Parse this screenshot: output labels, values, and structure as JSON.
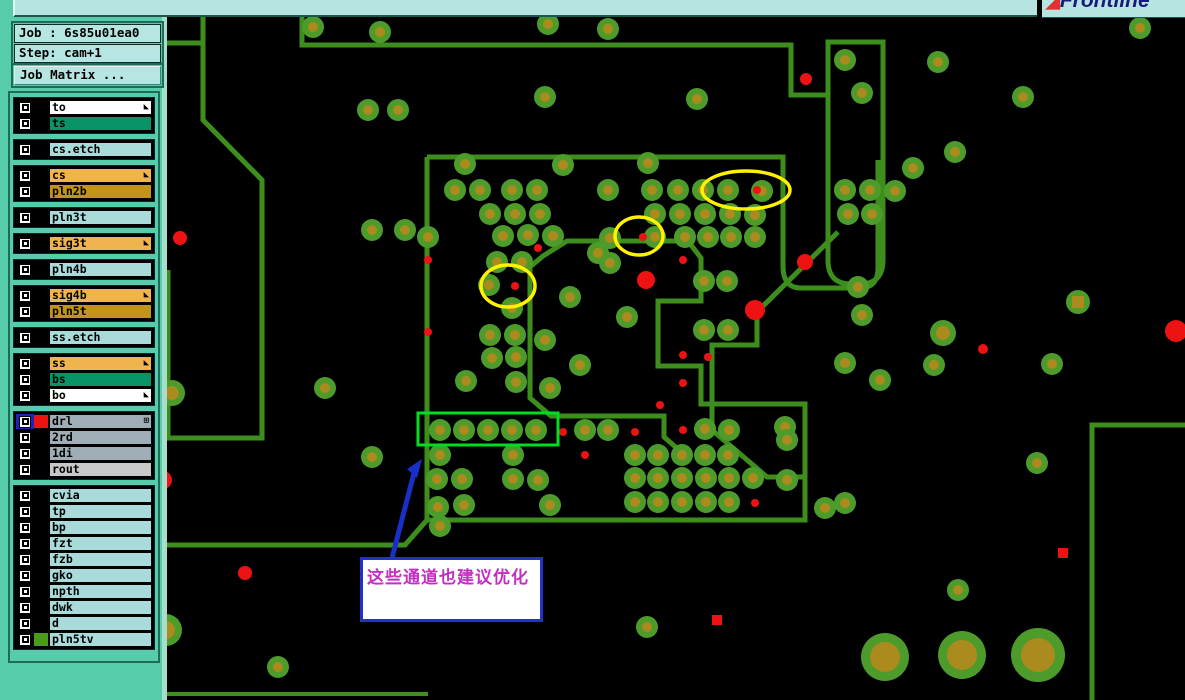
{
  "window": {
    "logo_text": "Frontline",
    "logo_swoosh_icon": "◢"
  },
  "job_panel": {
    "job_label": "Job : 6s85u01ea0",
    "step_label": "Step: cam+1",
    "matrix_button": "Job Matrix ..."
  },
  "colors": {
    "sidebar_teal": "#56CCAA",
    "panel_light": "#B6E6E2",
    "row_blue": "#A9DBDB",
    "row_orange": "#F0B44E",
    "row_gold": "#C2941C",
    "row_green": "#089367",
    "row_gray": "#9FAEB6",
    "row_rout": "#C8C8C8",
    "selected_checkbox_blue": "#2222BB",
    "drl_swatch_red": "#EE1313",
    "pln5tv_swatch_green": "#4A9A20"
  },
  "layers": [
    {
      "name": "to",
      "bg": "#FFFFFF",
      "group": 0,
      "arrow": true
    },
    {
      "name": "ts",
      "bg": "#089367",
      "group": 0
    },
    {
      "name": "cs.etch",
      "bg": "#A9DBDB",
      "group": 1
    },
    {
      "name": "cs",
      "bg": "#F0B44E",
      "group": 2,
      "arrow": true
    },
    {
      "name": "pln2b",
      "bg": "#C2941C",
      "group": 2
    },
    {
      "name": "pln3t",
      "bg": "#A9DBDB",
      "group": 3
    },
    {
      "name": "sig3t",
      "bg": "#F0B44E",
      "group": 4,
      "arrow": true
    },
    {
      "name": "pln4b",
      "bg": "#A9DBDB",
      "group": 5
    },
    {
      "name": "sig4b",
      "bg": "#F0B44E",
      "group": 6,
      "arrow": true
    },
    {
      "name": "pln5t",
      "bg": "#C2941C",
      "group": 6
    },
    {
      "name": "ss.etch",
      "bg": "#A9DBDB",
      "group": 7
    },
    {
      "name": "ss",
      "bg": "#F0B44E",
      "group": 8,
      "arrow": true
    },
    {
      "name": "bs",
      "bg": "#089367",
      "group": 8
    },
    {
      "name": "bo",
      "bg": "#FFFFFF",
      "group": 8,
      "arrow": true
    },
    {
      "name": "drl",
      "bg": "#9FAEB6",
      "group": 9,
      "selected": true,
      "swatch": "#EE1313",
      "grid": true
    },
    {
      "name": "2rd",
      "bg": "#9FAEB6",
      "group": 9
    },
    {
      "name": "1di",
      "bg": "#9FAEB6",
      "group": 9
    },
    {
      "name": "rout",
      "bg": "#C8C8C8",
      "group": 9
    },
    {
      "name": "cvia",
      "bg": "#A9DBDB",
      "group": 10
    },
    {
      "name": "tp",
      "bg": "#A9DBDB",
      "group": 10
    },
    {
      "name": "bp",
      "bg": "#A9DBDB",
      "group": 10
    },
    {
      "name": "fzt",
      "bg": "#A9DBDB",
      "group": 10
    },
    {
      "name": "fzb",
      "bg": "#A9DBDB",
      "group": 10
    },
    {
      "name": "gko",
      "bg": "#A9DBDB",
      "group": 10
    },
    {
      "name": "npth",
      "bg": "#A9DBDB",
      "group": 10
    },
    {
      "name": "dwk",
      "bg": "#A9DBDB",
      "group": 10
    },
    {
      "name": "d",
      "bg": "#A9DBDB",
      "group": 10
    },
    {
      "name": "pln5tv",
      "bg": "#A9DBDB",
      "group": 10,
      "swatch": "#4A9A20"
    }
  ],
  "canvas": {
    "background": "#000000",
    "trace_color": "#3E8E1E",
    "pad_outer": "#4C9B2B",
    "pad_inner": "#AB8A1E",
    "drill_color": "#EE1313",
    "highlight_yellow": "#FFF200",
    "highlight_green": "#00DD22",
    "arrow_color": "#1830C8",
    "traces": [
      {
        "d": "M203,17 L203,120 L262,180 L262,438 L168,438 L168,270",
        "w": 5
      },
      {
        "d": "M167,43 L203,43",
        "w": 5
      },
      {
        "d": "M302,17 L302,45 L791,45 L791,95 L828,95",
        "w": 5
      },
      {
        "d": "M828,95 L828,42 L883,42 L883,260 Q883,284 860,284 L851,284 Q828,284 828,260 L828,95",
        "w": 5
      },
      {
        "d": "M427,157 L783,157 L783,266 Q783,288 801,288 L860,288 Q878,288 878,268 L878,160",
        "w": 5
      },
      {
        "d": "M427,157 L427,520 L805,520 L805,404 L701,404 L701,366 L658,366 L658,301 L701,301 L701,258 L688,241 L567,241 L543,256 L530,267 L530,398 L551,416 L664,416 L664,437 L686,456",
        "w": 5
      },
      {
        "d": "M427,520 L405,545 L167,545",
        "w": 5
      },
      {
        "d": "M838,232 L757,312 L757,345 L712,345 L712,430 L767,477 L805,477",
        "w": 5
      },
      {
        "d": "M1092,700 L1092,425 L1185,425",
        "w": 5
      },
      {
        "d": "M167,694 L428,694",
        "w": 4
      }
    ],
    "pads": [
      [
        313,
        27,
        "s"
      ],
      [
        380,
        32,
        "s"
      ],
      [
        548,
        24,
        "s"
      ],
      [
        608,
        29,
        "s"
      ],
      [
        545,
        97,
        "s"
      ],
      [
        697,
        99,
        "s"
      ],
      [
        368,
        110,
        "s"
      ],
      [
        398,
        110,
        "s"
      ],
      [
        372,
        230,
        "s"
      ],
      [
        405,
        230,
        "s"
      ],
      [
        845,
        60,
        "s"
      ],
      [
        862,
        93,
        "s"
      ],
      [
        938,
        62,
        "s"
      ],
      [
        1023,
        97,
        "s"
      ],
      [
        1140,
        28,
        "s"
      ],
      [
        913,
        168,
        "s"
      ],
      [
        955,
        152,
        "s"
      ],
      [
        465,
        164,
        "s"
      ],
      [
        563,
        165,
        "s"
      ],
      [
        648,
        163,
        "s"
      ],
      [
        455,
        190,
        "s"
      ],
      [
        480,
        190,
        "s"
      ],
      [
        512,
        190,
        "s"
      ],
      [
        537,
        190,
        "s"
      ],
      [
        608,
        190,
        "s"
      ],
      [
        652,
        190,
        "s"
      ],
      [
        678,
        190,
        "s"
      ],
      [
        703,
        190,
        "s"
      ],
      [
        728,
        190,
        "s"
      ],
      [
        762,
        191,
        "s"
      ],
      [
        845,
        190,
        "s"
      ],
      [
        870,
        190,
        "s"
      ],
      [
        895,
        191,
        "s"
      ],
      [
        848,
        214,
        "s"
      ],
      [
        872,
        214,
        "s"
      ],
      [
        490,
        214,
        "s"
      ],
      [
        515,
        214,
        "s"
      ],
      [
        540,
        214,
        "s"
      ],
      [
        655,
        214,
        "s"
      ],
      [
        680,
        214,
        "s"
      ],
      [
        705,
        214,
        "s"
      ],
      [
        730,
        214,
        "s"
      ],
      [
        755,
        215,
        "s"
      ],
      [
        428,
        237,
        "s"
      ],
      [
        503,
        236,
        "s"
      ],
      [
        528,
        235,
        "s"
      ],
      [
        553,
        236,
        "s"
      ],
      [
        610,
        238,
        "s"
      ],
      [
        655,
        237,
        "s"
      ],
      [
        685,
        237,
        "s"
      ],
      [
        708,
        237,
        "s"
      ],
      [
        731,
        237,
        "s"
      ],
      [
        755,
        237,
        "s"
      ],
      [
        497,
        262,
        "s"
      ],
      [
        522,
        262,
        "s"
      ],
      [
        610,
        263,
        "s"
      ],
      [
        489,
        285,
        "s"
      ],
      [
        512,
        308,
        "s"
      ],
      [
        490,
        335,
        "s"
      ],
      [
        515,
        335,
        "s"
      ],
      [
        492,
        358,
        "s"
      ],
      [
        516,
        357,
        "s"
      ],
      [
        466,
        381,
        "s"
      ],
      [
        516,
        382,
        "s"
      ],
      [
        598,
        253,
        "s"
      ],
      [
        570,
        297,
        "s"
      ],
      [
        627,
        317,
        "s"
      ],
      [
        545,
        340,
        "s"
      ],
      [
        580,
        365,
        "s"
      ],
      [
        550,
        388,
        "s"
      ],
      [
        704,
        281,
        "s"
      ],
      [
        727,
        281,
        "s"
      ],
      [
        704,
        330,
        "s"
      ],
      [
        728,
        330,
        "s"
      ],
      [
        858,
        287,
        "s"
      ],
      [
        862,
        315,
        "s"
      ],
      [
        845,
        363,
        "s"
      ],
      [
        880,
        380,
        "s"
      ],
      [
        934,
        365,
        "s"
      ],
      [
        1052,
        364,
        "s"
      ],
      [
        958,
        590,
        "s"
      ],
      [
        1037,
        463,
        "s"
      ],
      [
        943,
        333,
        "m"
      ],
      [
        1078,
        302,
        "sq"
      ],
      [
        785,
        427,
        "s"
      ],
      [
        787,
        440,
        "s"
      ],
      [
        787,
        480,
        "s"
      ],
      [
        825,
        508,
        "s"
      ],
      [
        845,
        503,
        "s"
      ],
      [
        585,
        430,
        "s"
      ],
      [
        608,
        430,
        "s"
      ],
      [
        705,
        429,
        "s"
      ],
      [
        729,
        430,
        "s"
      ],
      [
        635,
        455,
        "s"
      ],
      [
        658,
        455,
        "s"
      ],
      [
        682,
        455,
        "s"
      ],
      [
        705,
        455,
        "s"
      ],
      [
        728,
        455,
        "s"
      ],
      [
        635,
        478,
        "s"
      ],
      [
        658,
        478,
        "s"
      ],
      [
        682,
        478,
        "s"
      ],
      [
        706,
        478,
        "s"
      ],
      [
        729,
        478,
        "s"
      ],
      [
        753,
        478,
        "s"
      ],
      [
        635,
        502,
        "s"
      ],
      [
        658,
        502,
        "s"
      ],
      [
        682,
        502,
        "s"
      ],
      [
        706,
        502,
        "s"
      ],
      [
        729,
        502,
        "s"
      ],
      [
        440,
        430,
        "s"
      ],
      [
        464,
        430,
        "s"
      ],
      [
        488,
        430,
        "s"
      ],
      [
        512,
        430,
        "s"
      ],
      [
        536,
        430,
        "s"
      ],
      [
        440,
        455,
        "s"
      ],
      [
        513,
        455,
        "s"
      ],
      [
        437,
        479,
        "s"
      ],
      [
        462,
        479,
        "s"
      ],
      [
        513,
        479,
        "s"
      ],
      [
        538,
        480,
        "s"
      ],
      [
        438,
        507,
        "s"
      ],
      [
        464,
        505,
        "s"
      ],
      [
        550,
        505,
        "s"
      ],
      [
        440,
        526,
        "s"
      ],
      [
        172,
        393,
        "m"
      ],
      [
        325,
        388,
        "s"
      ],
      [
        372,
        457,
        "s"
      ],
      [
        278,
        667,
        "s"
      ],
      [
        647,
        627,
        "s"
      ],
      [
        166,
        630,
        "l"
      ],
      [
        885,
        657,
        "xl"
      ],
      [
        962,
        655,
        "xl"
      ],
      [
        1038,
        655,
        "xxl"
      ]
    ],
    "dots": [
      [
        757,
        190,
        4
      ],
      [
        643,
        237,
        4
      ],
      [
        515,
        286,
        4
      ],
      [
        538,
        248,
        4
      ],
      [
        683,
        260,
        4
      ],
      [
        683,
        355,
        4
      ],
      [
        708,
        357,
        4
      ],
      [
        683,
        383,
        4
      ],
      [
        660,
        405,
        4
      ],
      [
        563,
        432,
        4
      ],
      [
        635,
        432,
        4
      ],
      [
        683,
        430,
        4
      ],
      [
        585,
        455,
        4
      ],
      [
        755,
        503,
        4
      ],
      [
        428,
        260,
        4
      ],
      [
        428,
        332,
        4
      ],
      [
        983,
        349,
        5
      ],
      [
        806,
        79,
        6
      ],
      [
        717,
        620,
        5,
        "sq"
      ],
      [
        1063,
        553,
        5,
        "sq"
      ],
      [
        180,
        238,
        7
      ],
      [
        245,
        573,
        7
      ],
      [
        805,
        262,
        8
      ],
      [
        646,
        280,
        9
      ],
      [
        755,
        310,
        10
      ],
      [
        1176,
        331,
        11
      ],
      [
        163,
        480,
        9
      ]
    ],
    "ellipses": [
      [
        746,
        190,
        44,
        19
      ],
      [
        639,
        236,
        24,
        19
      ],
      [
        508,
        286,
        27,
        21
      ]
    ],
    "rect": [
      418,
      413,
      140,
      32
    ],
    "arrow": {
      "line": [
        392,
        558,
        414,
        473
      ],
      "head": "422,459 407,469 417,478"
    },
    "note": {
      "text": "这些通道也建议优化",
      "x": 360,
      "y": 557,
      "w": 183,
      "h": 65
    }
  }
}
